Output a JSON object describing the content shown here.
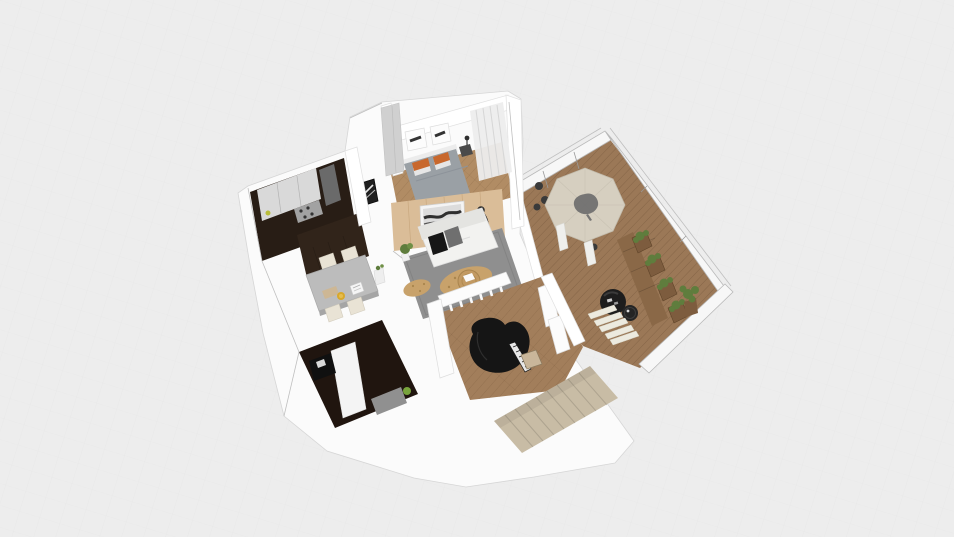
{
  "canvas": {
    "kind": "3d-floorplan-orbit-render",
    "background": "#ededed",
    "visible_text": "none"
  },
  "palette": {
    "background": "#ededed",
    "grid_line": "#e3e3e3",
    "base_white": "#fbfbfb",
    "wood_floor": "#a27e5b",
    "bedroom_floor": "#b18c64",
    "deck_floor": "#9b7857",
    "accent_wall_oak": "#dabd98",
    "kitchen_dark": "#281d15",
    "cabinet_light": "#d9d9d9",
    "stainless": "#a2a2a2",
    "pantry_brown": "#31241a",
    "office_floor": "#20150f",
    "rug_gray": "#8f8f8f",
    "rug_tan": "#c8a26b",
    "sofa_white": "#f2f2f0",
    "pillow_black": "#161616",
    "pillow_gray": "#6f6f6f",
    "bed_duvet": "#9aa0a5",
    "pillow_orange": "#c8682d",
    "table_gray": "#bcbcbc",
    "chair_beige": "#e9e3d5",
    "piano_black": "#151515",
    "piano_bench": "#c9b69a",
    "stairs_beige": "#c8bca5",
    "umbrella_beige": "#d6cfc0",
    "umbrella_center": "#6e6e6e",
    "planter_wood": "#7d5c3e",
    "bench_wood": "#8a6847",
    "plant_green": "#5f7d3d",
    "egg_chair_black": "#1d1d1d",
    "frame_art_dark": "#2f2f2f",
    "item_yellow": "#d8a82b",
    "curtain_gray": "#ededed",
    "wardrobe_gray": "#d0d0d0",
    "desk_black": "#101010",
    "bench_gray": "#909090"
  },
  "objects": {
    "kitchen": [
      "dark-cabinet-block",
      "upper-cabinets",
      "fridge",
      "cooktop"
    ],
    "dining": [
      "gray-table",
      "four-beige-chairs",
      "yellow-plate",
      "serving-board",
      "tablet"
    ],
    "bedroom": [
      "double-bed",
      "orange-pillows",
      "wall-frames",
      "nightstand-lamp",
      "wardrobe",
      "foot-bench",
      "sheer-curtains"
    ],
    "living": [
      "oak-accent-wall",
      "panoramic-art",
      "white-sofa",
      "black-pillow",
      "gray-pillow",
      "gray-rug",
      "tan-shag-patches",
      "wicker-coffee-table",
      "floor-lamp",
      "potted-plant"
    ],
    "office": [
      "dark-floor",
      "white-desk",
      "black-desk",
      "gray-bench",
      "plant"
    ],
    "piano_room": [
      "grand-piano",
      "piano-bench",
      "white-railing",
      "columns"
    ],
    "stairs": [
      "carpeted-staircase"
    ],
    "deck": [
      "patio-umbrella-table",
      "umbrella-posts",
      "dark-chairs",
      "glass-enclosure",
      "wood-bench",
      "planter-boxes",
      "green-plants",
      "black-egg-chair",
      "side-table",
      "deck-steps",
      "corner-potted-plant"
    ]
  }
}
